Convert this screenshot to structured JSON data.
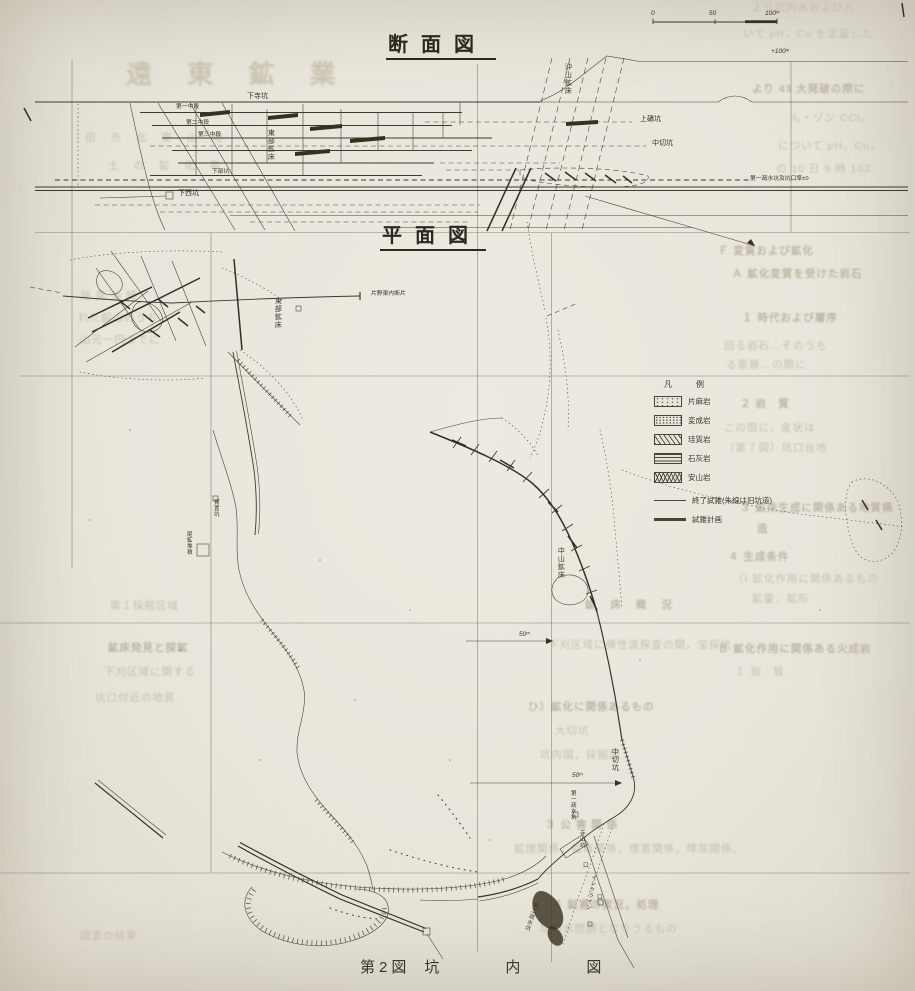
{
  "figure": {
    "fig_no": "第2図",
    "title": "坑内図"
  },
  "titles": {
    "section": "断面図",
    "plan": "平面図"
  },
  "scale_bar": {
    "ticks": [
      "0",
      "50",
      "100ᵐ"
    ]
  },
  "annotations": {
    "elevation": "+100ᵐ"
  },
  "legend": {
    "header": "凡　例",
    "rocks": [
      {
        "label": "片麻岩",
        "pattern": "p-dots"
      },
      {
        "label": "変成岩",
        "pattern": "p-dots2"
      },
      {
        "label": "珪質岩",
        "pattern": "p-diag"
      },
      {
        "label": "石灰岩",
        "pattern": "p-horiz"
      },
      {
        "label": "安山岩",
        "pattern": "p-wavy"
      }
    ],
    "symbols": [
      {
        "label": "終了試錐(朱線は旧坑道)",
        "line": "thin"
      },
      {
        "label": "試錐計画",
        "line": "thick"
      }
    ]
  },
  "map_labels": [
    {
      "n": "elevation-label",
      "t": "+100ᵐ",
      "x": 771,
      "y": 49,
      "cls": "i"
    },
    {
      "n": "scale-tick-0",
      "t": "0",
      "x": 651,
      "y": 11,
      "cls": "i"
    },
    {
      "n": "scale-tick-50",
      "t": "50",
      "x": 709,
      "y": 11,
      "cls": "i"
    },
    {
      "n": "scale-tick-100",
      "t": "100ᵐ",
      "x": 765,
      "y": 11,
      "cls": "i"
    },
    {
      "n": "level-kamiseki",
      "t": "上磧坑",
      "x": 640,
      "y": 116,
      "cls": "s"
    },
    {
      "n": "level-nakagiri",
      "t": "中切坑",
      "x": 652,
      "y": 140,
      "cls": "s"
    },
    {
      "n": "orebody-okiyama",
      "t": "沖山鉱床",
      "x": 564,
      "y": 63,
      "cls": "v"
    },
    {
      "n": "orebody-tobu-section",
      "t": "東部鉱床",
      "x": 267,
      "y": 129,
      "cls": "v"
    },
    {
      "n": "adit-shimotera",
      "t": "下寺坑",
      "x": 247,
      "y": 93,
      "cls": "s"
    },
    {
      "n": "sublevel-1",
      "t": "第一中段",
      "x": 176,
      "y": 104,
      "cls": "xs"
    },
    {
      "n": "sublevel-2",
      "t": "第二中段",
      "x": 186,
      "y": 120,
      "cls": "xs"
    },
    {
      "n": "sublevel-3",
      "t": "第三中段",
      "x": 198,
      "y": 132,
      "cls": "xs"
    },
    {
      "n": "lower-adit",
      "t": "下部坑",
      "x": 212,
      "y": 169,
      "cls": "xs"
    },
    {
      "n": "shaft-shimonishi",
      "t": "下西坑",
      "x": 178,
      "y": 190,
      "cls": "s"
    },
    {
      "n": "datum-label",
      "t": "第一疏水坑及坑口準±0",
      "x": 750,
      "y": 176,
      "cls": "xs"
    },
    {
      "n": "fault-katano",
      "t": "片野東内断片",
      "x": 371,
      "y": 291,
      "cls": "xs"
    },
    {
      "n": "orebody-tobu-plan",
      "t": "東部鉱床",
      "x": 274,
      "y": 297,
      "cls": "v"
    },
    {
      "n": "orebody-nakayama",
      "t": "中山鉱床",
      "x": 557,
      "y": 547,
      "cls": "v"
    },
    {
      "n": "adit-nakagiri-plan",
      "t": "中切坑",
      "x": 611,
      "y": 748,
      "cls": "v"
    },
    {
      "n": "drainage-adit-1",
      "t": "第一疏水坑",
      "x": 569,
      "y": 790,
      "cls": "xsv"
    },
    {
      "n": "adit-terayama",
      "t": "寺山坑",
      "x": 578,
      "y": 830,
      "cls": "xsv"
    },
    {
      "n": "drainage-adit-2",
      "t": "第二疏水坑",
      "x": 532,
      "y": 901,
      "cls": "xsv",
      "rot": 18
    },
    {
      "n": "incline-label",
      "t": "インクライン",
      "x": 590,
      "y": 874,
      "cls": "xsv",
      "rot": 10
    },
    {
      "n": "tailings-label",
      "t": "尾鉱堆積",
      "x": 185,
      "y": 531,
      "cls": "xsv"
    },
    {
      "n": "hosho-adit",
      "t": "寳置坑",
      "x": 212,
      "y": 499,
      "cls": "xsv"
    },
    {
      "n": "distance-50m-a",
      "t": "50ᵐ",
      "x": 519,
      "y": 632,
      "cls": "i"
    },
    {
      "n": "distance-50m-b",
      "t": "50ᵐ",
      "x": 572,
      "y": 773,
      "cls": "i"
    },
    {
      "n": "portal-mark-a",
      "t": "口",
      "x": 597,
      "y": 895,
      "cls": "xs"
    },
    {
      "n": "portal-mark-b",
      "t": "口",
      "x": 583,
      "y": 863,
      "cls": "xs"
    }
  ],
  "bleed_text": [
    {
      "t": "遠 東 鉱 業",
      "x": 126,
      "y": 54,
      "cls": "big"
    },
    {
      "t": "田 市 北 東 山 地",
      "x": 85,
      "y": 130,
      "cls": "sp"
    },
    {
      "t": "土 の 鉱 化 帯",
      "x": 108,
      "y": 158,
      "cls": "sp"
    },
    {
      "t": "発 見 当 時",
      "x": 80,
      "y": 288,
      "cls": ""
    },
    {
      "t": "れた銅山のうち",
      "x": 78,
      "y": 310,
      "cls": ""
    },
    {
      "t": "山元一円までに",
      "x": 80,
      "y": 332,
      "cls": ""
    },
    {
      "t": "第１採掘区域",
      "x": 110,
      "y": 598,
      "cls": ""
    },
    {
      "t": "鉱床発見と探鉱",
      "x": 108,
      "y": 640,
      "cls": "b"
    },
    {
      "t": "下刈区域に関する",
      "x": 104,
      "y": 664,
      "cls": ""
    },
    {
      "t": "坑口付近の地質",
      "x": 95,
      "y": 690,
      "cls": ""
    },
    {
      "t": "調査の結果",
      "x": 80,
      "y": 928,
      "cls": ""
    },
    {
      "t": "より坑内水および九",
      "x": 752,
      "y": 0,
      "cls": ""
    },
    {
      "t": "いて pH，Cu を定量した.",
      "x": 743,
      "y": 26,
      "cls": ""
    },
    {
      "t": "より 43 大発破の際に",
      "x": 752,
      "y": 81,
      "cls": "b"
    },
    {
      "t": "ん・ゾン CCl₄",
      "x": 790,
      "y": 110,
      "cls": ""
    },
    {
      "t": "について pH，Cu，",
      "x": 778,
      "y": 138,
      "cls": ""
    },
    {
      "t": "の 10 日 9 時 102",
      "x": 776,
      "y": 161,
      "cls": ""
    },
    {
      "t": "Ｆ 変質および鉱化",
      "x": 718,
      "y": 243,
      "cls": "b"
    },
    {
      "t": "Ａ 鉱化変質を受けた岩石",
      "x": 732,
      "y": 266,
      "cls": "b"
    },
    {
      "t": "１ 時代および層序",
      "x": 742,
      "y": 310,
      "cls": "b"
    },
    {
      "t": "回る岩石…そのうち",
      "x": 724,
      "y": 338,
      "cls": ""
    },
    {
      "t": "る累層…の間に",
      "x": 726,
      "y": 357,
      "cls": ""
    },
    {
      "t": "２ 岩　質",
      "x": 740,
      "y": 396,
      "cls": "b"
    },
    {
      "t": "この間に，産状は",
      "x": 724,
      "y": 420,
      "cls": ""
    },
    {
      "t": "（第７図）坑口台地",
      "x": 724,
      "y": 440,
      "cls": ""
    },
    {
      "t": "３ 鉱床生成に関係ある地質構",
      "x": 740,
      "y": 500,
      "cls": "b"
    },
    {
      "t": "造",
      "x": 757,
      "y": 521,
      "cls": "b"
    },
    {
      "t": "４ 生成条件",
      "x": 728,
      "y": 549,
      "cls": "b"
    },
    {
      "t": "（ⅰ 鉱化作用に関係あるもの",
      "x": 733,
      "y": 571,
      "cls": ""
    },
    {
      "t": "鉱量，鉱形",
      "x": 752,
      "y": 591,
      "cls": ""
    },
    {
      "t": "Ｂ 鉱化作用に関係ある火成岩",
      "x": 718,
      "y": 641,
      "cls": "b"
    },
    {
      "t": "１ 岩　質",
      "x": 735,
      "y": 664,
      "cls": ""
    },
    {
      "t": "鉱 床 概 況",
      "x": 585,
      "y": 597,
      "cls": "b sp"
    },
    {
      "t": "下刈区域に弾性波探査の間，宝探坑",
      "x": 548,
      "y": 637,
      "cls": ""
    },
    {
      "t": "ひ）鉱化に関係あるもの",
      "x": 528,
      "y": 699,
      "cls": "b"
    },
    {
      "t": "大切坑",
      "x": 555,
      "y": 723,
      "cls": ""
    },
    {
      "t": "坑内図，採掘図.",
      "x": 540,
      "y": 747,
      "cls": ""
    },
    {
      "t": "３ 公 害 関 係",
      "x": 545,
      "y": 817,
      "cls": "b"
    },
    {
      "t": "鉱煙関係，鉱毒関係，煙害関係，降灰関係,",
      "x": 514,
      "y": 841,
      "cls": ""
    },
    {
      "t": "４ 鉱害の実況，処理",
      "x": 552,
      "y": 897,
      "cls": "b"
    },
    {
      "t": "坑内水問題となりうるもの",
      "x": 540,
      "y": 921,
      "cls": ""
    }
  ],
  "colors": {
    "paper": "#e8e5db",
    "ink": "#3e382d",
    "grid": "#7b7363",
    "bleed": "#c1baa8"
  }
}
